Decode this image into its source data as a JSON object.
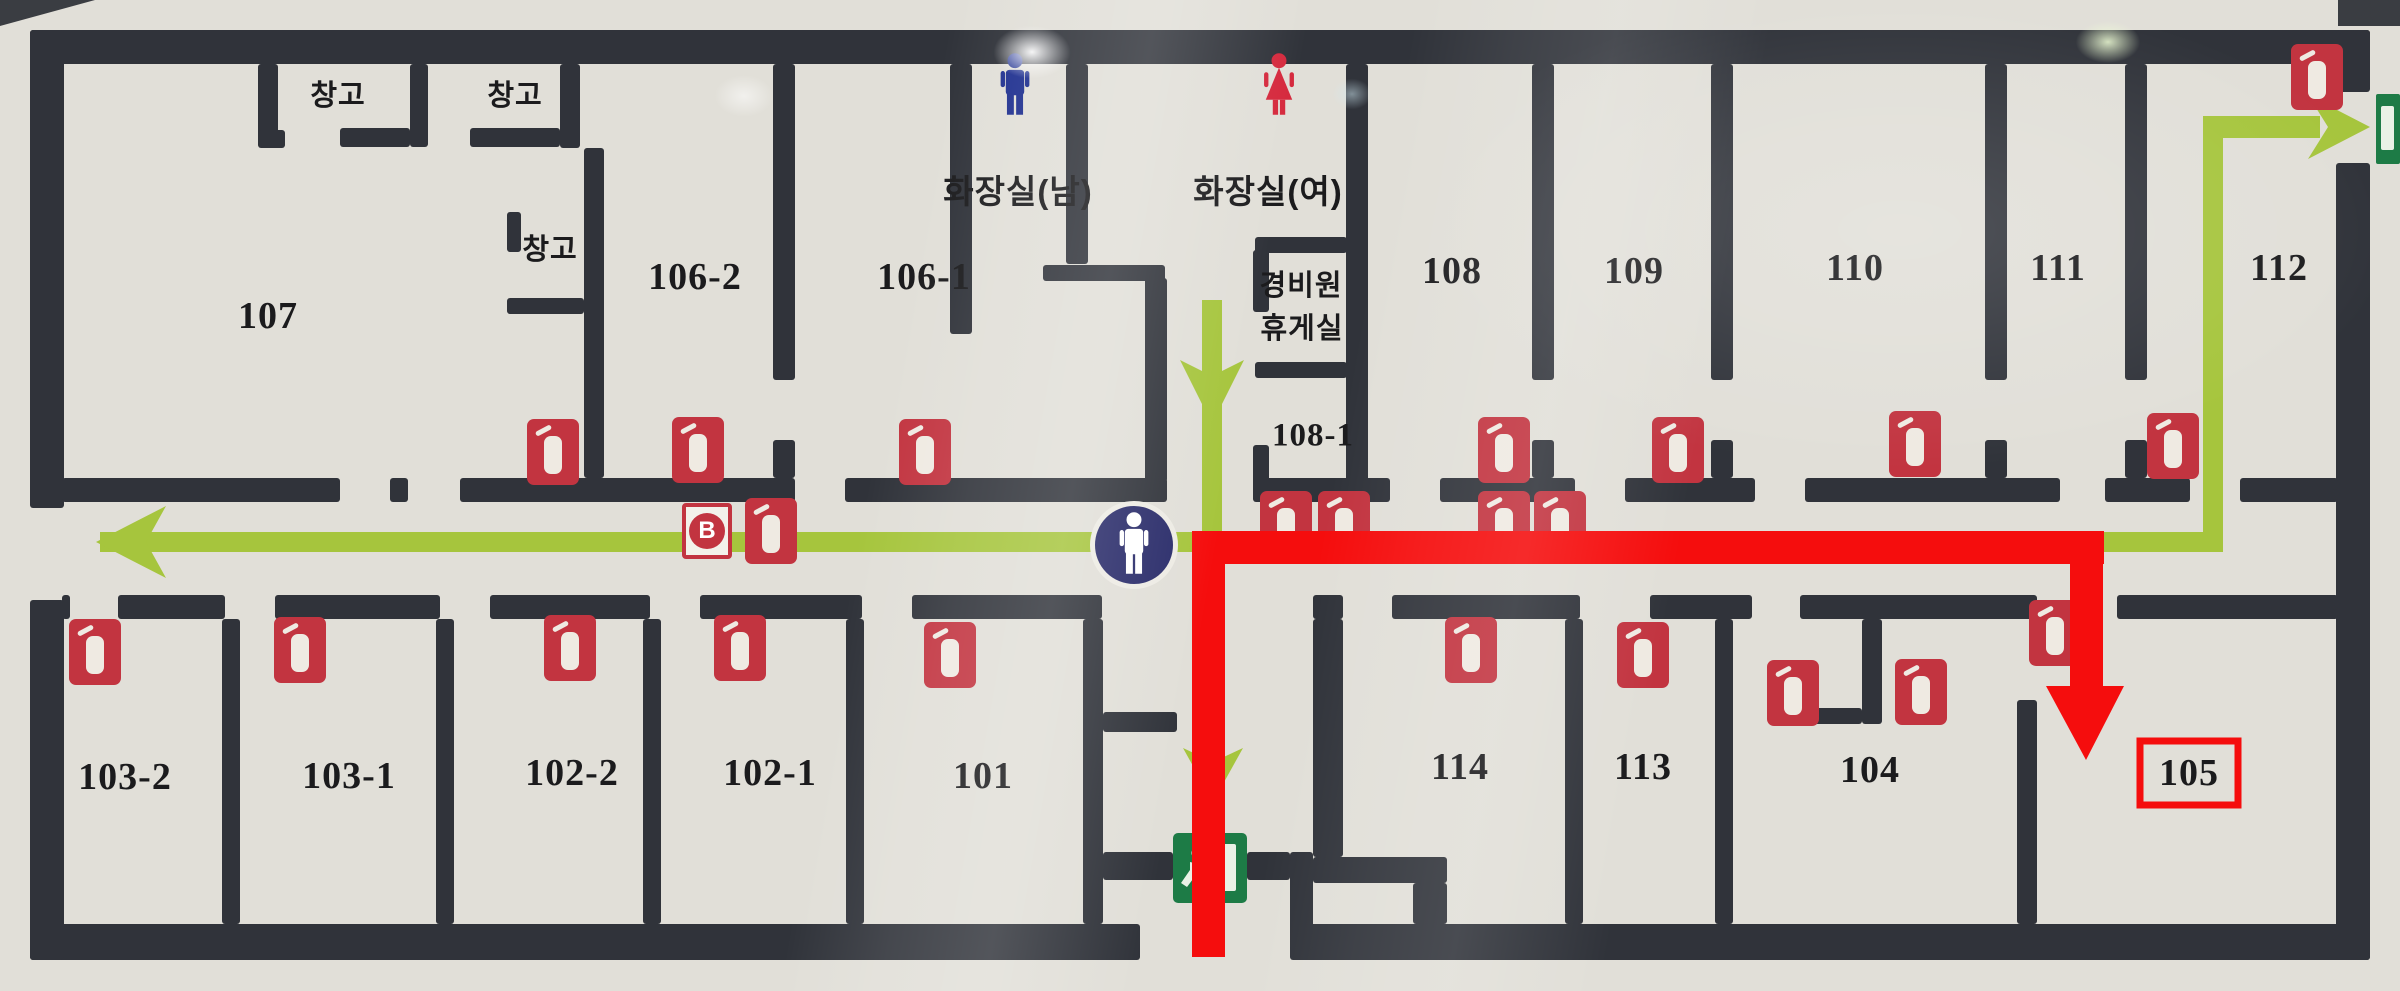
{
  "map": {
    "type": "building-evacuation-floorplan",
    "canvas": {
      "width": 2400,
      "height": 991,
      "floor_color": "#e1dfd8",
      "wall_color": "#30333a"
    },
    "colors": {
      "route_green": "#a6c53d",
      "route_red": "#f50d0d",
      "extinguisher_red": "#c23440",
      "exit_green": "#1d7b46",
      "location_navy": "#2a2c6a",
      "mens_blue": "#1e2f8f",
      "womens_red": "#d5293d"
    },
    "labels": [
      {
        "id": "room-107",
        "text": "107",
        "x": 268,
        "y": 316,
        "cls": "num"
      },
      {
        "id": "room-106-2",
        "text": "106-2",
        "x": 695,
        "y": 277,
        "cls": "num"
      },
      {
        "id": "room-106-1",
        "text": "106-1",
        "x": 924,
        "y": 277,
        "cls": "num"
      },
      {
        "id": "room-108",
        "text": "108",
        "x": 1452,
        "y": 271,
        "cls": "num"
      },
      {
        "id": "room-109",
        "text": "109",
        "x": 1634,
        "y": 271,
        "cls": "num"
      },
      {
        "id": "room-110",
        "text": "110",
        "x": 1855,
        "y": 268,
        "cls": "num"
      },
      {
        "id": "room-111",
        "text": "111",
        "x": 2058,
        "y": 268,
        "cls": "num"
      },
      {
        "id": "room-112",
        "text": "112",
        "x": 2279,
        "y": 268,
        "cls": "num"
      },
      {
        "id": "room-103-2",
        "text": "103-2",
        "x": 125,
        "y": 777,
        "cls": "num"
      },
      {
        "id": "room-103-1",
        "text": "103-1",
        "x": 349,
        "y": 776,
        "cls": "num"
      },
      {
        "id": "room-102-2",
        "text": "102-2",
        "x": 572,
        "y": 773,
        "cls": "num"
      },
      {
        "id": "room-102-1",
        "text": "102-1",
        "x": 770,
        "y": 773,
        "cls": "num"
      },
      {
        "id": "room-101",
        "text": "101",
        "x": 983,
        "y": 776,
        "cls": "num"
      },
      {
        "id": "room-114",
        "text": "114",
        "x": 1460,
        "y": 767,
        "cls": "num"
      },
      {
        "id": "room-113",
        "text": "113",
        "x": 1643,
        "y": 767,
        "cls": "num"
      },
      {
        "id": "room-104",
        "text": "104",
        "x": 1870,
        "y": 770,
        "cls": "num"
      },
      {
        "id": "room-105",
        "text": "105",
        "x": 2189,
        "y": 773,
        "cls": "num"
      },
      {
        "id": "room-108-1",
        "text": "108-1",
        "x": 1313,
        "y": 436,
        "cls": "num-sm"
      },
      {
        "id": "storage-1",
        "text": "창고",
        "x": 338,
        "y": 93,
        "cls": "kr"
      },
      {
        "id": "storage-2",
        "text": "창고",
        "x": 515,
        "y": 93,
        "cls": "kr"
      },
      {
        "id": "storage-3",
        "text": "창고",
        "x": 550,
        "y": 247,
        "cls": "kr"
      },
      {
        "id": "mens-restroom",
        "text": "화장실(남)",
        "x": 1018,
        "y": 189,
        "cls": "kr-lg"
      },
      {
        "id": "womens-restroom",
        "text": "화장실(여)",
        "x": 1268,
        "y": 189,
        "cls": "kr-lg"
      },
      {
        "id": "guard-room-line1",
        "text": "경비원",
        "x": 1301,
        "y": 283,
        "cls": "kr"
      },
      {
        "id": "guard-room-line2",
        "text": "휴게실",
        "x": 1302,
        "y": 326,
        "cls": "kr"
      }
    ],
    "walls": [
      [
        30,
        30,
        2340,
        34
      ],
      [
        30,
        924,
        1110,
        36
      ],
      [
        1290,
        924,
        1080,
        36
      ],
      [
        30,
        30,
        34,
        478
      ],
      [
        30,
        600,
        34,
        360
      ],
      [
        2336,
        30,
        34,
        62
      ],
      [
        2336,
        163,
        34,
        797
      ],
      [
        62,
        478,
        278,
        24
      ],
      [
        390,
        478,
        18,
        24
      ],
      [
        460,
        478,
        335,
        24
      ],
      [
        845,
        478,
        322,
        24
      ],
      [
        1255,
        478,
        135,
        24
      ],
      [
        1440,
        478,
        135,
        24
      ],
      [
        1625,
        478,
        130,
        24
      ],
      [
        1805,
        478,
        255,
        24
      ],
      [
        2105,
        478,
        85,
        24
      ],
      [
        2240,
        478,
        98,
        24
      ],
      [
        62,
        595,
        8,
        24
      ],
      [
        118,
        595,
        107,
        24
      ],
      [
        275,
        595,
        165,
        24
      ],
      [
        490,
        595,
        160,
        24
      ],
      [
        700,
        595,
        162,
        24
      ],
      [
        912,
        595,
        190,
        24
      ],
      [
        1313,
        595,
        30,
        24
      ],
      [
        1392,
        595,
        188,
        24
      ],
      [
        1650,
        595,
        102,
        24
      ],
      [
        1800,
        595,
        237,
        24
      ],
      [
        2117,
        595,
        221,
        24
      ],
      [
        258,
        64,
        20,
        73
      ],
      [
        258,
        130,
        27,
        18
      ],
      [
        340,
        128,
        70,
        19
      ],
      [
        410,
        64,
        18,
        83
      ],
      [
        470,
        128,
        90,
        19
      ],
      [
        560,
        64,
        20,
        84
      ],
      [
        584,
        148,
        20,
        330
      ],
      [
        507,
        212,
        14,
        40
      ],
      [
        507,
        298,
        77,
        16
      ],
      [
        773,
        64,
        22,
        316
      ],
      [
        773,
        440,
        22,
        38
      ],
      [
        950,
        64,
        22,
        270
      ],
      [
        1066,
        64,
        22,
        200
      ],
      [
        1043,
        265,
        122,
        16
      ],
      [
        1145,
        278,
        22,
        204
      ],
      [
        1346,
        64,
        22,
        438
      ],
      [
        1255,
        237,
        92,
        16
      ],
      [
        1253,
        250,
        16,
        62
      ],
      [
        1255,
        362,
        92,
        16
      ],
      [
        1253,
        445,
        16,
        57
      ],
      [
        1532,
        64,
        22,
        316
      ],
      [
        1532,
        440,
        22,
        38
      ],
      [
        1711,
        64,
        22,
        316
      ],
      [
        1711,
        440,
        22,
        38
      ],
      [
        1985,
        64,
        22,
        316
      ],
      [
        1985,
        440,
        22,
        38
      ],
      [
        2125,
        64,
        22,
        316
      ],
      [
        2125,
        440,
        22,
        38
      ],
      [
        222,
        619,
        18,
        305
      ],
      [
        436,
        619,
        18,
        305
      ],
      [
        643,
        619,
        18,
        305
      ],
      [
        846,
        619,
        18,
        305
      ],
      [
        1083,
        619,
        20,
        305
      ],
      [
        1103,
        712,
        74,
        20
      ],
      [
        1103,
        852,
        70,
        28
      ],
      [
        1247,
        852,
        43,
        28
      ],
      [
        1290,
        852,
        23,
        98
      ],
      [
        1313,
        619,
        30,
        238
      ],
      [
        1313,
        857,
        134,
        26
      ],
      [
        1413,
        883,
        34,
        41
      ],
      [
        1565,
        619,
        18,
        305
      ],
      [
        1715,
        619,
        18,
        305
      ],
      [
        1862,
        619,
        20,
        105
      ],
      [
        1790,
        708,
        72,
        16
      ],
      [
        2017,
        700,
        20,
        224
      ]
    ],
    "extinguishers": [
      [
        553,
        452
      ],
      [
        698,
        450
      ],
      [
        925,
        452
      ],
      [
        1504,
        450
      ],
      [
        1678,
        450
      ],
      [
        1915,
        444
      ],
      [
        2173,
        446
      ],
      [
        2317,
        77
      ],
      [
        771,
        531
      ],
      [
        1286,
        524
      ],
      [
        1344,
        524
      ],
      [
        1504,
        524
      ],
      [
        1560,
        524
      ],
      [
        95,
        652
      ],
      [
        300,
        650
      ],
      [
        570,
        648
      ],
      [
        740,
        648
      ],
      [
        950,
        655
      ],
      [
        1471,
        650
      ],
      [
        1643,
        655
      ],
      [
        1793,
        693
      ],
      [
        1921,
        692
      ],
      [
        2055,
        633
      ]
    ],
    "b_marker": {
      "label": "B",
      "x": 682,
      "y": 503
    },
    "person_location": {
      "x": 1134,
      "y": 545
    },
    "restroom_icons": {
      "men": {
        "x": 992,
        "y": 52
      },
      "women": {
        "x": 1256,
        "y": 52
      }
    },
    "exits": {
      "bottom_door": [
        1173,
        833,
        74,
        70
      ],
      "top_right_sign": [
        2376,
        94,
        24,
        70
      ]
    },
    "green_route": {
      "segments": [
        [
          100,
          532,
          2112,
          20
        ],
        [
          1202,
          300,
          20,
          232
        ],
        [
          2203,
          116,
          20,
          436
        ],
        [
          2212,
          116,
          108,
          22
        ]
      ],
      "arrows": [
        "96,542 166,506 146,542 166,578",
        "1180,360 1212,376 1244,360 1212,424",
        "2370,127 2308,95 2328,127 2308,159",
        "1183,748 1213,762 1243,748 1213,802"
      ]
    },
    "red_route": {
      "destination": "105",
      "segments": [
        [
          1192,
          531,
          33,
          426
        ],
        [
          1192,
          531,
          912,
          33
        ],
        [
          2070,
          560,
          33,
          132
        ]
      ],
      "arrow": "2046,686 2124,686 2086,760",
      "highlight_box": [
        2140,
        741,
        98,
        64
      ]
    }
  }
}
